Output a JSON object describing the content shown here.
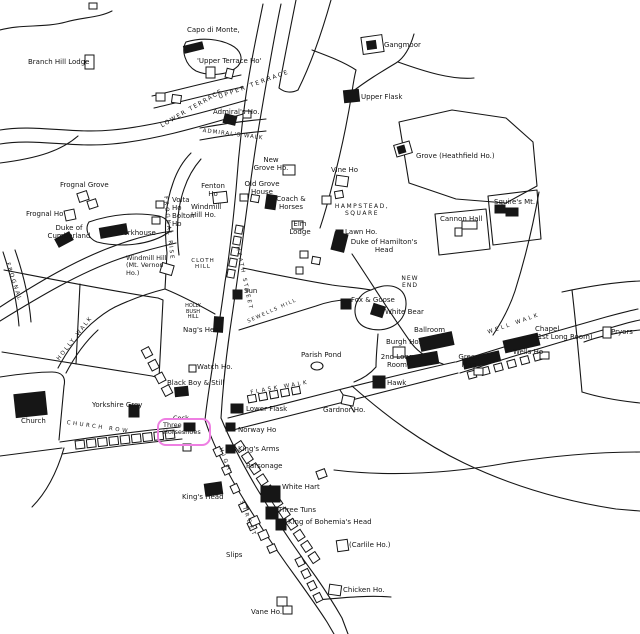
{
  "map": {
    "ink": "#161616",
    "background": "#ffffff",
    "highlight": {
      "color": "#ee7fe2",
      "box": {
        "x": 157,
        "y": 418,
        "w": 54,
        "h": 28
      },
      "label": [
        "Three",
        "Horseshoes"
      ]
    },
    "labels": [
      {
        "t": "Branch Hill Lodge",
        "x": 28,
        "y": 59
      },
      {
        "t": "Capo di Monte,",
        "x": 187,
        "y": 27
      },
      {
        "t": "'Upper Terrace Ho'",
        "x": 197,
        "y": 58
      },
      {
        "t": "UPPER TERRACE",
        "x": 218,
        "y": 95,
        "s": 6,
        "sp": 2,
        "r": -20
      },
      {
        "t": "LOWER TERRACE",
        "x": 160,
        "y": 124,
        "s": 6,
        "sp": 1.5,
        "r": -30
      },
      {
        "t": "Admiral's Ho.",
        "x": 213,
        "y": 109
      },
      {
        "t": "ADMIRAL'S WALK",
        "x": 203,
        "y": 128,
        "s": 5.5,
        "sp": 1,
        "r": 7
      },
      {
        "t": "Gangmoor",
        "x": 384,
        "y": 42
      },
      {
        "t": "Upper Flask",
        "x": 361,
        "y": 94
      },
      {
        "t": "Grove (Heathfield Ho.)",
        "x": 416,
        "y": 153
      },
      {
        "t": "Squire's Mt.",
        "x": 494,
        "y": 199
      },
      {
        "t": "Cannon Hall",
        "x": 440,
        "y": 216
      },
      {
        "t": "Vine Ho",
        "x": 331,
        "y": 167
      },
      {
        "lines": [
          "New",
          "Grove Ho."
        ],
        "x": 271,
        "y": 157,
        "c": 1
      },
      {
        "lines": [
          "Old Grove",
          "House"
        ],
        "x": 262,
        "y": 181,
        "c": 1
      },
      {
        "lines": [
          "Coach &",
          "Horses"
        ],
        "x": 291,
        "y": 196,
        "c": 1
      },
      {
        "lines": [
          "HAMPSTEAD,",
          "SQUARE"
        ],
        "x": 362,
        "y": 204,
        "s": 6,
        "sp": 1.5,
        "c": 1
      },
      {
        "lines": [
          "Elm",
          "Lodge"
        ],
        "x": 300,
        "y": 221,
        "c": 1
      },
      {
        "t": "Lawn Ho.",
        "x": 345,
        "y": 229
      },
      {
        "lines": [
          "Duke of Hamilton's",
          "Head"
        ],
        "x": 384,
        "y": 239,
        "c": 1
      },
      {
        "lines": [
          "Fenton",
          "Ho"
        ],
        "x": 213,
        "y": 183,
        "c": 1
      },
      {
        "lines": [
          "Volta",
          "Ho"
        ],
        "x": 172,
        "y": 197
      },
      {
        "lines": [
          "Windmill",
          "Hill Ho."
        ],
        "x": 191,
        "y": 204
      },
      {
        "lines": [
          "Bolton",
          "Ho"
        ],
        "x": 172,
        "y": 213
      },
      {
        "t": "Frognal Grove",
        "x": 60,
        "y": 182
      },
      {
        "t": "Frognal Ho",
        "x": 26,
        "y": 211
      },
      {
        "lines": [
          "Duke of",
          "Cumberland"
        ],
        "x": 69,
        "y": 225,
        "c": 1
      },
      {
        "t": "Workhouse",
        "x": 117,
        "y": 230
      },
      {
        "lines": [
          "Windmill Hill",
          "(Mt. Vernon",
          "Ho.)"
        ],
        "x": 126,
        "y": 255,
        "s": 6.5
      },
      {
        "t": "FROGNAL RISE",
        "x": 168,
        "y": 196,
        "s": 5.5,
        "sp": 2,
        "r": 84
      },
      {
        "t": "FROGNAL",
        "x": 10,
        "y": 262,
        "s": 5.5,
        "sp": 2,
        "r": 72
      },
      {
        "lines": [
          "CLOTH",
          "HILL"
        ],
        "x": 203,
        "y": 258,
        "s": 5.5,
        "sp": 1,
        "c": 1
      },
      {
        "t": "HEATH STREET",
        "x": 240,
        "y": 246,
        "s": 5.5,
        "sp": 2,
        "r": 78
      },
      {
        "t": "Sun",
        "x": 244,
        "y": 288
      },
      {
        "lines": [
          "HOLLY",
          "BUSH",
          "HILL"
        ],
        "x": 193,
        "y": 304,
        "s": 5,
        "c": 1
      },
      {
        "t": "Nag's Head",
        "x": 183,
        "y": 327
      },
      {
        "t": "Watch Ho.",
        "x": 197,
        "y": 364
      },
      {
        "t": "Black Boy & Still",
        "x": 167,
        "y": 380
      },
      {
        "t": "Yorkshire Grey",
        "x": 92,
        "y": 402
      },
      {
        "t": "Church",
        "x": 21,
        "y": 418
      },
      {
        "t": "CHURCH ROW",
        "x": 67,
        "y": 420,
        "s": 5.5,
        "sp": 2.5,
        "r": 8
      },
      {
        "t": "HOLLY WALK",
        "x": 56,
        "y": 358,
        "s": 5.5,
        "sp": 2,
        "r": -52
      },
      {
        "t": "Cock",
        "x": 173,
        "y": 415,
        "s": 6.5
      },
      {
        "t": "Lower Flask",
        "x": 246,
        "y": 406
      },
      {
        "t": "Norway Ho",
        "x": 238,
        "y": 427
      },
      {
        "t": "King's Arms",
        "x": 238,
        "y": 446
      },
      {
        "t": "Parsonage",
        "x": 246,
        "y": 463
      },
      {
        "t": "FLASK WALK",
        "x": 250,
        "y": 390,
        "s": 5.5,
        "sp": 2.5,
        "r": -10
      },
      {
        "t": "Gardnor Ho.",
        "x": 323,
        "y": 407
      },
      {
        "t": "Hawk",
        "x": 387,
        "y": 380
      },
      {
        "lines": [
          "2nd Long",
          "Room"
        ],
        "x": 397,
        "y": 354,
        "c": 1
      },
      {
        "t": "Burgh Ho.",
        "x": 386,
        "y": 339
      },
      {
        "t": "Ballroom",
        "x": 414,
        "y": 327
      },
      {
        "t": "White Bear",
        "x": 385,
        "y": 309
      },
      {
        "t": "Fox & Goose",
        "x": 351,
        "y": 297
      },
      {
        "lines": [
          "NEW",
          "END"
        ],
        "x": 410,
        "y": 276,
        "s": 6,
        "sp": 1,
        "c": 1
      },
      {
        "t": "Parish Pond",
        "x": 301,
        "y": 352
      },
      {
        "lines": [
          "Green",
          "Man"
        ],
        "x": 469,
        "y": 354,
        "c": 1
      },
      {
        "t": "Wells Ho",
        "x": 513,
        "y": 349
      },
      {
        "lines": [
          "Chapel",
          "(1st Long Room)"
        ],
        "x": 535,
        "y": 326
      },
      {
        "t": "WELL WALK",
        "x": 487,
        "y": 330,
        "s": 5.5,
        "sp": 2.5,
        "r": -19
      },
      {
        "t": "Pryors",
        "x": 611,
        "y": 329
      },
      {
        "t": "SEWELLS HILL",
        "x": 247,
        "y": 320,
        "s": 5,
        "sp": 1.5,
        "r": -24
      },
      {
        "t": "HIGH",
        "x": 223,
        "y": 447,
        "s": 5.5,
        "sp": 3,
        "r": 70
      },
      {
        "t": "STREET",
        "x": 244,
        "y": 500,
        "s": 5.5,
        "sp": 3,
        "r": 70
      },
      {
        "t": "King's Head",
        "x": 182,
        "y": 494
      },
      {
        "t": "White Hart",
        "x": 282,
        "y": 484
      },
      {
        "t": "Three Tuns",
        "x": 278,
        "y": 507
      },
      {
        "t": "King of Bohemia's Head",
        "x": 288,
        "y": 519
      },
      {
        "t": "Slips",
        "x": 226,
        "y": 552
      },
      {
        "t": "(Carlile Ho.)",
        "x": 349,
        "y": 542
      },
      {
        "t": "Chicken Ho.",
        "x": 343,
        "y": 587
      },
      {
        "t": "Vane Ho.",
        "x": 251,
        "y": 609
      }
    ]
  }
}
